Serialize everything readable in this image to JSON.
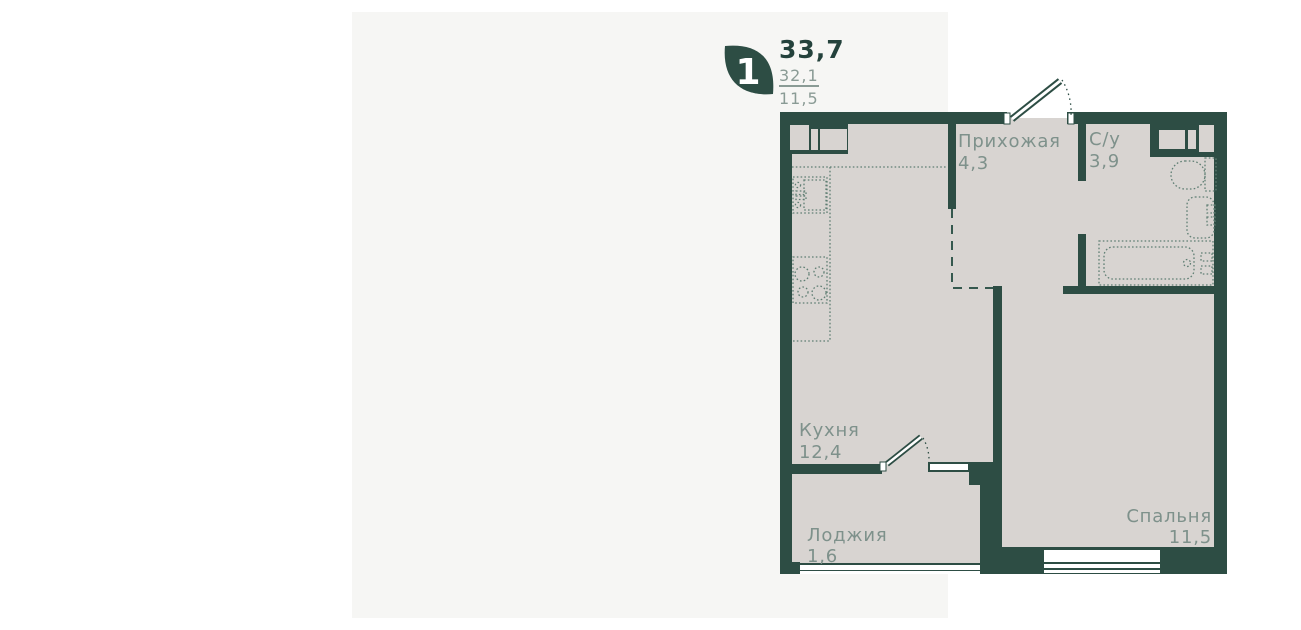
{
  "plan_card": {
    "badge": {
      "rooms_count": "1"
    },
    "areas": {
      "total": "33,7",
      "living": "32,1",
      "room": "11,5"
    }
  },
  "rooms": {
    "hallway": {
      "name": "Прихожая",
      "area": "4,3"
    },
    "bathroom": {
      "name": "С/у",
      "area": "3,9"
    },
    "kitchen": {
      "name": "Кухня",
      "area": "12,4"
    },
    "loggia": {
      "name": "Лоджия",
      "area": "1,6"
    },
    "bedroom": {
      "name": "Спальня",
      "area": "11,5"
    }
  },
  "colors": {
    "wall": "#2d4d44",
    "floor": "#d8d4d1",
    "card_background": "#f6f6f4",
    "page_background": "#ffffff",
    "label_text": "#7e918b",
    "stat_total_text": "#24423c",
    "stat_secondary_text": "#8a9b95"
  }
}
